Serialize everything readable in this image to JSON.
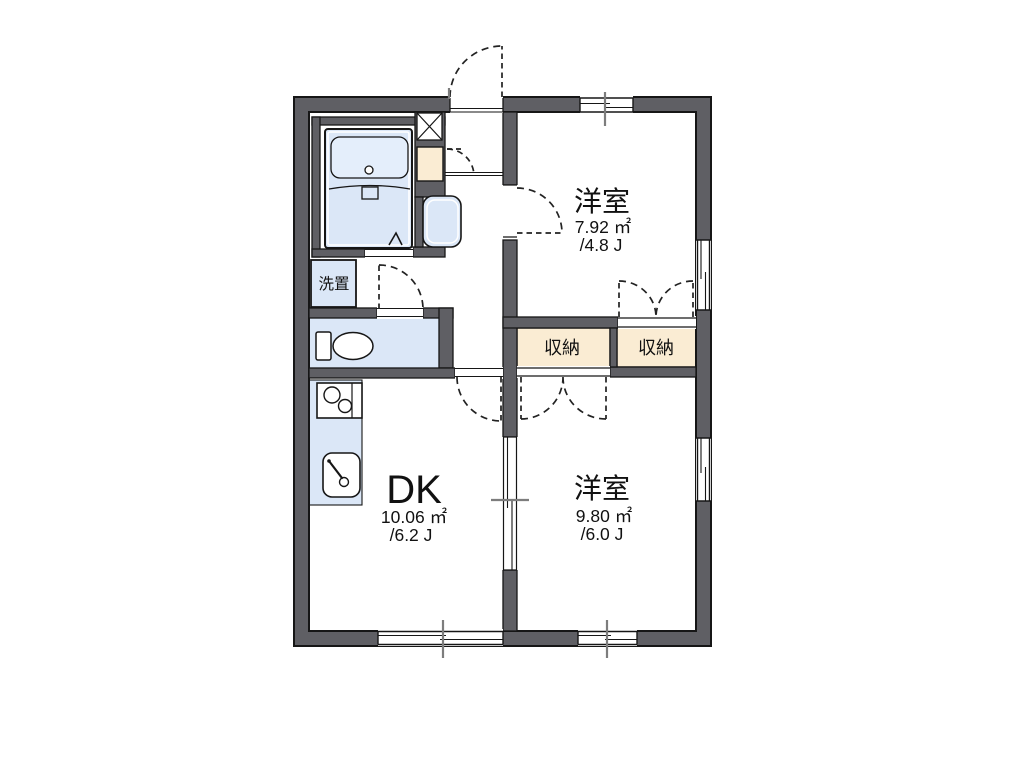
{
  "floorplan": {
    "rooms": {
      "top": {
        "name": "洋室",
        "area": "7.92 ㎡",
        "tatami": "/4.8 J"
      },
      "bottom": {
        "name": "洋室",
        "area": "9.80 ㎡",
        "tatami": "/6.0 J"
      },
      "dk": {
        "name": "DK",
        "area": "10.06 ㎡",
        "tatami": "/6.2 J"
      }
    },
    "closets": {
      "left": "収納",
      "right": "収納"
    },
    "laundry": {
      "label": "洗置"
    },
    "colors": {
      "wall": "#5f5f64",
      "outline": "#161616",
      "water_fixture": "#dbe7f7",
      "water_fixture_light": "#e4eefb",
      "closet": "#faecd3",
      "tick": "#7d7d7d",
      "background": "#ffffff"
    }
  }
}
